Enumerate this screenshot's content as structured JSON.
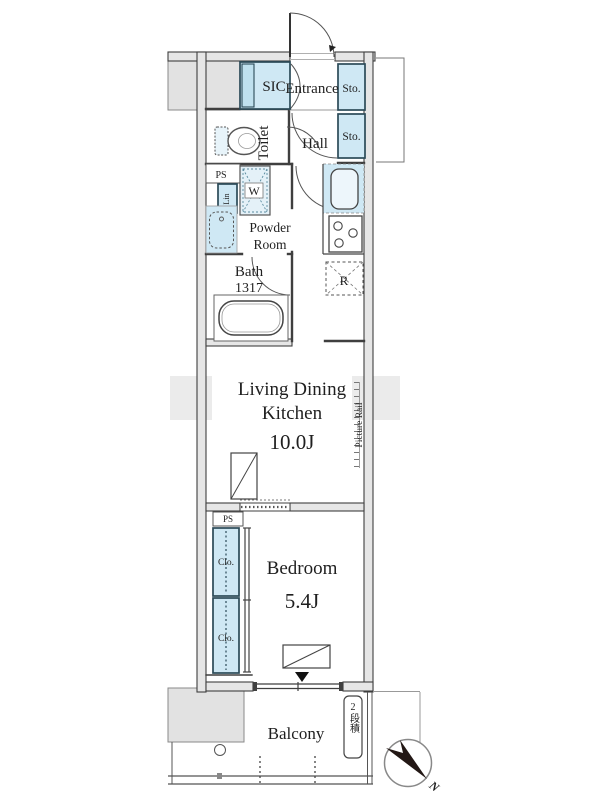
{
  "colors": {
    "light_blue": "#cfe8f4",
    "fixture_blue": "#e8f4fa",
    "wall_fill": "#e6e6e6",
    "wall_stroke": "#3f3f3f",
    "box_border": "#2b4a58",
    "gray_block": "#e2e2e2",
    "text": "#1f1f1f",
    "needle": "#231815"
  },
  "plan": {
    "upper": {
      "sic": "SIC",
      "entrance": "Entrance",
      "sto_top": "Sto.",
      "sto_bottom": "Sto.",
      "toilet": "Toilet",
      "hall": "Hall"
    },
    "utility": {
      "ps": "PS",
      "linen": "Lin",
      "washer": "W",
      "powder_line1": "Powder",
      "powder_line2": "Room",
      "bath": "Bath",
      "bath_module": "1317",
      "fridge": "R"
    },
    "ldk": {
      "line1": "Living Dining",
      "line2": "Kitchen",
      "size": "10.0J",
      "picture_rail": "Picture Rail"
    },
    "bedroom": {
      "name": "Bedroom",
      "size": "5.4J",
      "ps": "PS",
      "closet_top": "Clo.",
      "closet_bottom": "Clo."
    },
    "balcony": {
      "name": "Balcony",
      "stacked_note": "2段積"
    },
    "compass": {
      "north": "N"
    }
  }
}
